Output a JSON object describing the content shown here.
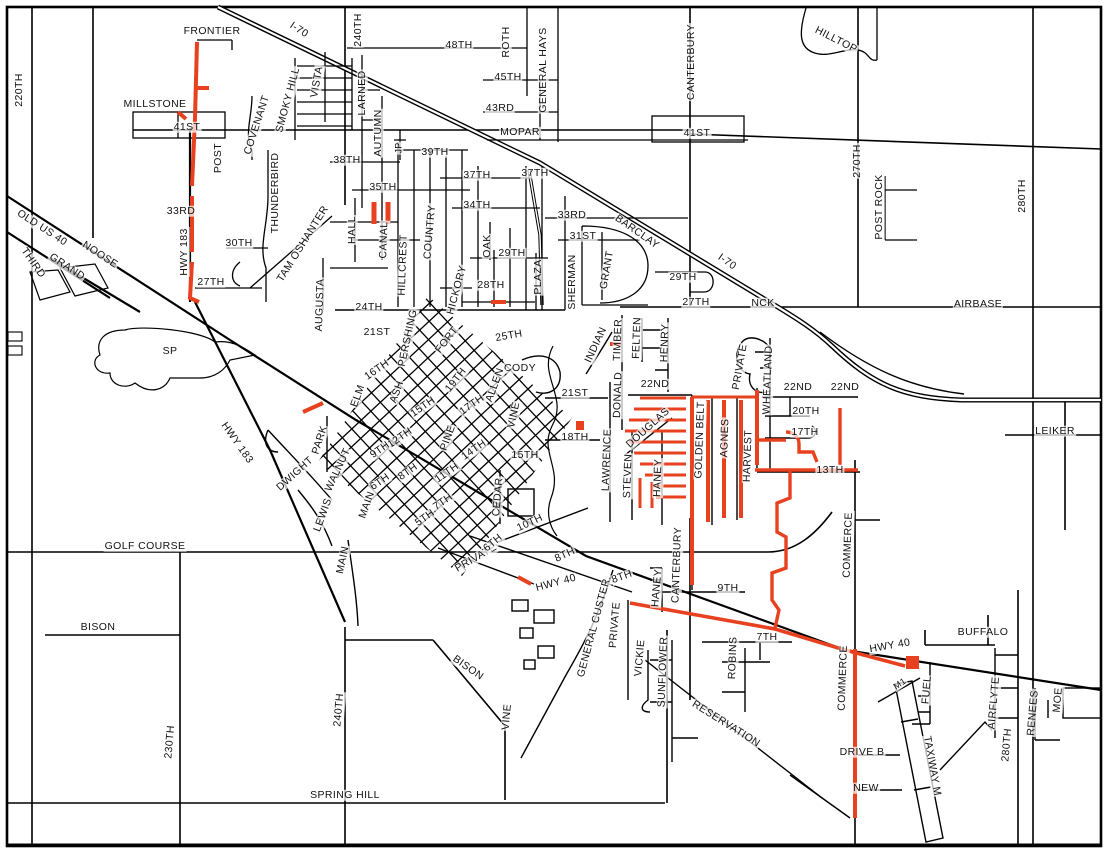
{
  "map_title": "City street map with highlighted road segments",
  "colors": {
    "road": "#000000",
    "highlight": "#e8411f",
    "background": "#ffffff",
    "label": "#111111"
  },
  "legend": {
    "highlight_meaning": "highlighted street segments"
  },
  "labels": [
    {
      "t": "FRONTIER",
      "x": 212,
      "y": 31,
      "r": 0
    },
    {
      "t": "I-70",
      "x": 299,
      "y": 30,
      "r": 33
    },
    {
      "t": "240TH",
      "x": 358,
      "y": 30,
      "r": -90
    },
    {
      "t": "48TH",
      "x": 459,
      "y": 45,
      "r": 0
    },
    {
      "t": "ROTH",
      "x": 506,
      "y": 42,
      "r": -90
    },
    {
      "t": "GENERAL HAYS",
      "x": 543,
      "y": 70,
      "r": -90
    },
    {
      "t": "45TH",
      "x": 508,
      "y": 77,
      "r": 0
    },
    {
      "t": "43RD",
      "x": 500,
      "y": 108,
      "r": 0
    },
    {
      "t": "MOPAR",
      "x": 520,
      "y": 132,
      "r": 0
    },
    {
      "t": "41ST",
      "x": 697,
      "y": 133,
      "r": 0
    },
    {
      "t": "CANTERBURY",
      "x": 691,
      "y": 62,
      "r": -90
    },
    {
      "t": "HILLTOP",
      "x": 836,
      "y": 40,
      "r": 27
    },
    {
      "t": "270TH",
      "x": 857,
      "y": 161,
      "r": -90
    },
    {
      "t": "POST ROCK",
      "x": 879,
      "y": 207,
      "r": -90
    },
    {
      "t": "280TH",
      "x": 1022,
      "y": 196,
      "r": -90
    },
    {
      "t": "220TH",
      "x": 19,
      "y": 90,
      "r": -90
    },
    {
      "t": "MILLSTONE",
      "x": 155,
      "y": 104,
      "r": 0
    },
    {
      "t": "41ST",
      "x": 187,
      "y": 127,
      "r": 0
    },
    {
      "t": "POST",
      "x": 218,
      "y": 158,
      "r": -90
    },
    {
      "t": "33RD",
      "x": 181,
      "y": 211,
      "r": 0
    },
    {
      "t": "HWY 183",
      "x": 184,
      "y": 252,
      "r": -90
    },
    {
      "t": "NOOSE",
      "x": 100,
      "y": 255,
      "r": 33
    },
    {
      "t": "OLD US 40",
      "x": 42,
      "y": 228,
      "r": 33
    },
    {
      "t": "THIRD",
      "x": 33,
      "y": 263,
      "r": 55
    },
    {
      "t": "GRAND",
      "x": 67,
      "y": 267,
      "r": 33
    },
    {
      "t": "27TH",
      "x": 211,
      "y": 282,
      "r": 0
    },
    {
      "t": "30TH",
      "x": 239,
      "y": 243,
      "r": 0
    },
    {
      "t": "COVENANT",
      "x": 257,
      "y": 125,
      "r": -72
    },
    {
      "t": "SMOKY HILL",
      "x": 288,
      "y": 100,
      "r": -75
    },
    {
      "t": "VISTA",
      "x": 317,
      "y": 82,
      "r": -80
    },
    {
      "t": "LARNED",
      "x": 362,
      "y": 93,
      "r": -90
    },
    {
      "t": "AUTUMN",
      "x": 378,
      "y": 133,
      "r": -90
    },
    {
      "t": "JP",
      "x": 399,
      "y": 148,
      "r": -90,
      "s": 9
    },
    {
      "t": "39TH",
      "x": 435,
      "y": 152,
      "r": 0
    },
    {
      "t": "38TH",
      "x": 347,
      "y": 160,
      "r": 0
    },
    {
      "t": "37TH",
      "x": 477,
      "y": 175,
      "r": 0
    },
    {
      "t": "37TH",
      "x": 535,
      "y": 173,
      "r": 0
    },
    {
      "t": "35TH",
      "x": 383,
      "y": 187,
      "r": 0
    },
    {
      "t": "34TH",
      "x": 477,
      "y": 205,
      "r": 0
    },
    {
      "t": "33RD",
      "x": 572,
      "y": 215,
      "r": 0
    },
    {
      "t": "BARCLAY",
      "x": 637,
      "y": 232,
      "r": 35
    },
    {
      "t": "31ST",
      "x": 583,
      "y": 236,
      "r": 0
    },
    {
      "t": "GRANT",
      "x": 607,
      "y": 270,
      "r": -80
    },
    {
      "t": "SHERMAN",
      "x": 572,
      "y": 282,
      "r": -90
    },
    {
      "t": "29TH",
      "x": 512,
      "y": 253,
      "r": 0
    },
    {
      "t": "28TH",
      "x": 491,
      "y": 285,
      "r": 0
    },
    {
      "t": "PLAZA",
      "x": 538,
      "y": 277,
      "r": -90
    },
    {
      "t": "OAK",
      "x": 487,
      "y": 246,
      "r": -90
    },
    {
      "t": "HICKORY",
      "x": 457,
      "y": 290,
      "r": -75
    },
    {
      "t": "COUNTRY",
      "x": 430,
      "y": 232,
      "r": -85
    },
    {
      "t": "HILLCREST",
      "x": 403,
      "y": 265,
      "r": -88
    },
    {
      "t": "CANAL",
      "x": 384,
      "y": 240,
      "r": -88
    },
    {
      "t": "HALL",
      "x": 352,
      "y": 230,
      "r": -90
    },
    {
      "t": "TAM OSHANTER",
      "x": 303,
      "y": 244,
      "r": -58
    },
    {
      "t": "AUGUSTA",
      "x": 320,
      "y": 305,
      "r": -88
    },
    {
      "t": "THUNDERBIRD",
      "x": 275,
      "y": 193,
      "r": -90
    },
    {
      "t": "29TH",
      "x": 683,
      "y": 277,
      "r": 0
    },
    {
      "t": "27TH",
      "x": 696,
      "y": 302,
      "r": 0
    },
    {
      "t": "NCK",
      "x": 763,
      "y": 303,
      "r": 0
    },
    {
      "t": "I-70",
      "x": 727,
      "y": 262,
      "r": 35
    },
    {
      "t": "AIRBASE",
      "x": 978,
      "y": 304,
      "r": 0
    },
    {
      "t": "24TH",
      "x": 369,
      "y": 307,
      "r": 0
    },
    {
      "t": "21ST",
      "x": 377,
      "y": 332,
      "r": 0
    },
    {
      "t": "PERSHING",
      "x": 408,
      "y": 338,
      "r": -78
    },
    {
      "t": "FORT",
      "x": 447,
      "y": 340,
      "r": -52
    },
    {
      "t": "25TH",
      "x": 509,
      "y": 336,
      "r": -10
    },
    {
      "t": "CODY",
      "x": 520,
      "y": 368,
      "r": 0
    },
    {
      "t": "19TH",
      "x": 456,
      "y": 380,
      "r": -52
    },
    {
      "t": "ALLEN",
      "x": 495,
      "y": 385,
      "r": -70
    },
    {
      "t": "VINE",
      "x": 514,
      "y": 415,
      "r": -78
    },
    {
      "t": "16TH",
      "x": 377,
      "y": 370,
      "r": -35
    },
    {
      "t": "ELM",
      "x": 358,
      "y": 396,
      "r": -70
    },
    {
      "t": "ASH",
      "x": 397,
      "y": 392,
      "r": -70
    },
    {
      "t": "15TH",
      "x": 423,
      "y": 407,
      "r": -35
    },
    {
      "t": "17TH",
      "x": 472,
      "y": 405,
      "r": -35
    },
    {
      "t": "12TH",
      "x": 400,
      "y": 438,
      "r": -35
    },
    {
      "t": "PINE",
      "x": 448,
      "y": 438,
      "r": -70
    },
    {
      "t": "14TH",
      "x": 474,
      "y": 450,
      "r": -35
    },
    {
      "t": "9TH",
      "x": 380,
      "y": 450,
      "r": -35
    },
    {
      "t": "WALNUT",
      "x": 338,
      "y": 470,
      "r": -65
    },
    {
      "t": "11TH",
      "x": 447,
      "y": 473,
      "r": -35
    },
    {
      "t": "8TH",
      "x": 408,
      "y": 472,
      "r": -35
    },
    {
      "t": "6TH",
      "x": 380,
      "y": 482,
      "r": -35
    },
    {
      "t": "7TH",
      "x": 443,
      "y": 502,
      "r": -35
    },
    {
      "t": "5TH",
      "x": 425,
      "y": 518,
      "r": -35
    },
    {
      "t": "MAIN",
      "x": 367,
      "y": 505,
      "r": -70
    },
    {
      "t": "LEWIS",
      "x": 323,
      "y": 515,
      "r": -70
    },
    {
      "t": "MAIN",
      "x": 343,
      "y": 560,
      "r": -78
    },
    {
      "t": "DWIGHT",
      "x": 295,
      "y": 474,
      "r": -42
    },
    {
      "t": "PARK",
      "x": 320,
      "y": 440,
      "r": -72
    },
    {
      "t": "SP",
      "x": 170,
      "y": 351,
      "r": 0
    },
    {
      "t": "HWY 183",
      "x": 237,
      "y": 443,
      "r": 55
    },
    {
      "t": "15TH",
      "x": 525,
      "y": 455,
      "r": 0
    },
    {
      "t": "21ST",
      "x": 575,
      "y": 393,
      "r": 0
    },
    {
      "t": "18TH",
      "x": 575,
      "y": 437,
      "r": 0
    },
    {
      "t": "INDIAN",
      "x": 596,
      "y": 345,
      "r": -65
    },
    {
      "t": "TIMBER",
      "x": 618,
      "y": 340,
      "r": -88
    },
    {
      "t": "DONALD",
      "x": 618,
      "y": 395,
      "r": -88
    },
    {
      "t": "FELTEN",
      "x": 637,
      "y": 338,
      "r": -88
    },
    {
      "t": "HENRY",
      "x": 665,
      "y": 343,
      "r": -88
    },
    {
      "t": "22ND",
      "x": 655,
      "y": 384,
      "r": 0
    },
    {
      "t": "LAWRENCE",
      "x": 607,
      "y": 460,
      "r": -88
    },
    {
      "t": "STEVEN",
      "x": 628,
      "y": 476,
      "r": -88
    },
    {
      "t": "DOUGLAS",
      "x": 648,
      "y": 428,
      "r": -42
    },
    {
      "t": "HANEY",
      "x": 658,
      "y": 478,
      "r": -88
    },
    {
      "t": "GOLDEN BELT",
      "x": 700,
      "y": 440,
      "r": -88
    },
    {
      "t": "AGNES",
      "x": 725,
      "y": 438,
      "r": -88
    },
    {
      "t": "HARVEST",
      "x": 748,
      "y": 456,
      "r": -88
    },
    {
      "t": "PRIVATE",
      "x": 740,
      "y": 367,
      "r": -80
    },
    {
      "t": "WHEATLAND",
      "x": 768,
      "y": 380,
      "r": -88
    },
    {
      "t": "22ND",
      "x": 798,
      "y": 387,
      "r": 0
    },
    {
      "t": "22ND",
      "x": 845,
      "y": 387,
      "r": 0
    },
    {
      "t": "20TH",
      "x": 806,
      "y": 411,
      "r": 0
    },
    {
      "t": "17TH",
      "x": 805,
      "y": 432,
      "r": 0
    },
    {
      "t": "13TH",
      "x": 830,
      "y": 470,
      "r": 0
    },
    {
      "t": "LEIKER",
      "x": 1055,
      "y": 431,
      "r": 0
    },
    {
      "t": "COMMERCE",
      "x": 848,
      "y": 545,
      "r": -88
    },
    {
      "t": "CEDAR",
      "x": 498,
      "y": 497,
      "r": -85
    },
    {
      "t": "10TH",
      "x": 530,
      "y": 523,
      "r": -25
    },
    {
      "t": "PRIVATE",
      "x": 476,
      "y": 558,
      "r": -30
    },
    {
      "t": "6TH",
      "x": 493,
      "y": 543,
      "r": -40
    },
    {
      "t": "8TH",
      "x": 565,
      "y": 555,
      "r": -25
    },
    {
      "t": "HWY 40",
      "x": 556,
      "y": 583,
      "r": -15
    },
    {
      "t": "GENERAL CUSTER",
      "x": 594,
      "y": 628,
      "r": -75
    },
    {
      "t": "8TH",
      "x": 622,
      "y": 577,
      "r": -20
    },
    {
      "t": "PRIVATE",
      "x": 615,
      "y": 625,
      "r": -85
    },
    {
      "t": "HANEY",
      "x": 657,
      "y": 588,
      "r": -85
    },
    {
      "t": "CANTERBURY",
      "x": 677,
      "y": 565,
      "r": -88
    },
    {
      "t": "9TH",
      "x": 728,
      "y": 588,
      "r": 0
    },
    {
      "t": "VICKIE",
      "x": 640,
      "y": 658,
      "r": -85
    },
    {
      "t": "SUNFLOWER",
      "x": 663,
      "y": 672,
      "r": -88
    },
    {
      "t": "ROBINS",
      "x": 733,
      "y": 658,
      "r": -88
    },
    {
      "t": "7TH",
      "x": 767,
      "y": 637,
      "r": 0
    },
    {
      "t": "RESERVATION",
      "x": 726,
      "y": 724,
      "r": 32
    },
    {
      "t": "COMMERCE",
      "x": 843,
      "y": 678,
      "r": -88
    },
    {
      "t": "HWY 40",
      "x": 890,
      "y": 646,
      "r": -10
    },
    {
      "t": "BUFFALO",
      "x": 983,
      "y": 632,
      "r": 0
    },
    {
      "t": "M1",
      "x": 900,
      "y": 684,
      "r": -35,
      "s": 9
    },
    {
      "t": "FUEL",
      "x": 927,
      "y": 690,
      "r": -85
    },
    {
      "t": "TAXIWAY M",
      "x": 932,
      "y": 766,
      "r": 80
    },
    {
      "t": "AIRFLYTE",
      "x": 994,
      "y": 703,
      "r": -85
    },
    {
      "t": "280TH",
      "x": 1007,
      "y": 745,
      "r": -85
    },
    {
      "t": "RENEES",
      "x": 1033,
      "y": 713,
      "r": -85
    },
    {
      "t": "MOE",
      "x": 1058,
      "y": 700,
      "r": -85
    },
    {
      "t": "DRIVE B",
      "x": 862,
      "y": 752,
      "r": 0
    },
    {
      "t": "NEW",
      "x": 866,
      "y": 788,
      "r": 0
    },
    {
      "t": "SPRING HILL",
      "x": 345,
      "y": 795,
      "r": 0
    },
    {
      "t": "240TH",
      "x": 339,
      "y": 710,
      "r": -85
    },
    {
      "t": "BISON",
      "x": 468,
      "y": 668,
      "r": 35
    },
    {
      "t": "VINE",
      "x": 507,
      "y": 717,
      "r": -85
    },
    {
      "t": "230TH",
      "x": 170,
      "y": 742,
      "r": -85
    },
    {
      "t": "BISON",
      "x": 98,
      "y": 627,
      "r": 0
    },
    {
      "t": "GOLF COURSE",
      "x": 145,
      "y": 546,
      "r": 0
    }
  ]
}
